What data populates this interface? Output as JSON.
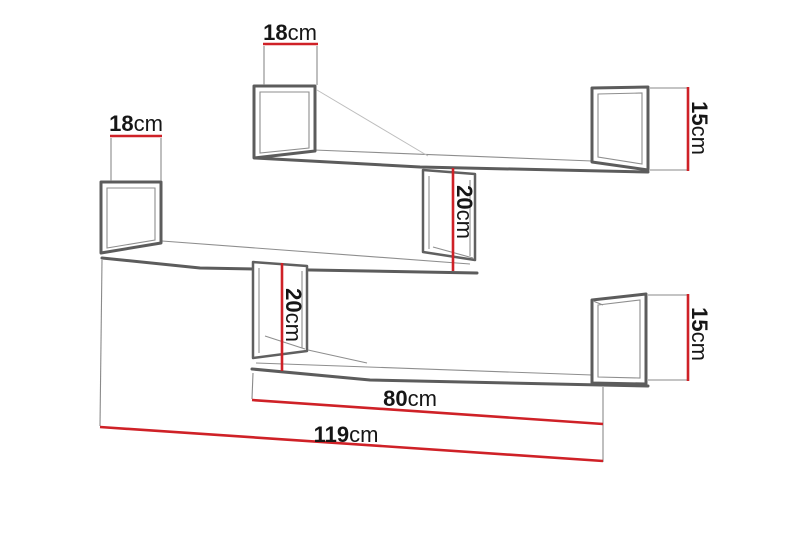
{
  "diagram": {
    "type": "furniture-dimension-drawing",
    "unit": "cm",
    "colors": {
      "dimension_line": "#cf2127",
      "shelf_outline": "#5c5c5c",
      "extension_line": "#8a8a8a",
      "label_text": "#161616",
      "background": "#ffffff"
    },
    "dimensions": {
      "top_shelf_depth": {
        "value": "18",
        "unit": "cm"
      },
      "left_shelf_depth": {
        "value": "18",
        "unit": "cm"
      },
      "top_shelf_end_height": {
        "value": "15",
        "unit": "cm"
      },
      "upper_shelf_gap": {
        "value": "20",
        "unit": "cm"
      },
      "lower_shelf_gap": {
        "value": "20",
        "unit": "cm"
      },
      "bottom_shelf_end_height": {
        "value": "15",
        "unit": "cm"
      },
      "bottom_shelf_length": {
        "value": "80",
        "unit": "cm"
      },
      "total_width": {
        "value": "119",
        "unit": "cm"
      }
    }
  }
}
